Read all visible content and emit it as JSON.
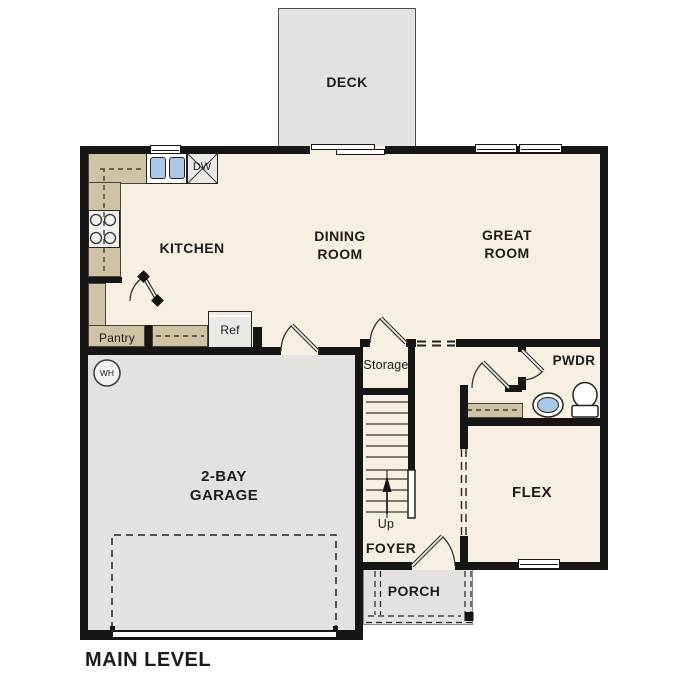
{
  "title": "MAIN LEVEL",
  "colors": {
    "wall": "#161616",
    "floor": "#f7efe1",
    "hard": "#e3e2e0",
    "counter": "#d0c2a5",
    "blue": "#a9c8e5",
    "appliance": "#eae9e6",
    "outline": "#333330",
    "text": "#1c1c1c"
  },
  "rooms": {
    "deck": "DECK",
    "kitchen": "KITCHEN",
    "dining": "DINING ROOM",
    "great": "GREAT ROOM",
    "garage": "2-BAY GARAGE",
    "flex": "FLEX",
    "powder": "PWDR",
    "foyer": "FOYER",
    "porch": "PORCH",
    "storage": "Storage",
    "pantry": "Pantry"
  },
  "fixtures": {
    "dishwasher": "DW",
    "refrigerator": "Ref",
    "water_heater": "WH",
    "up": "Up"
  }
}
